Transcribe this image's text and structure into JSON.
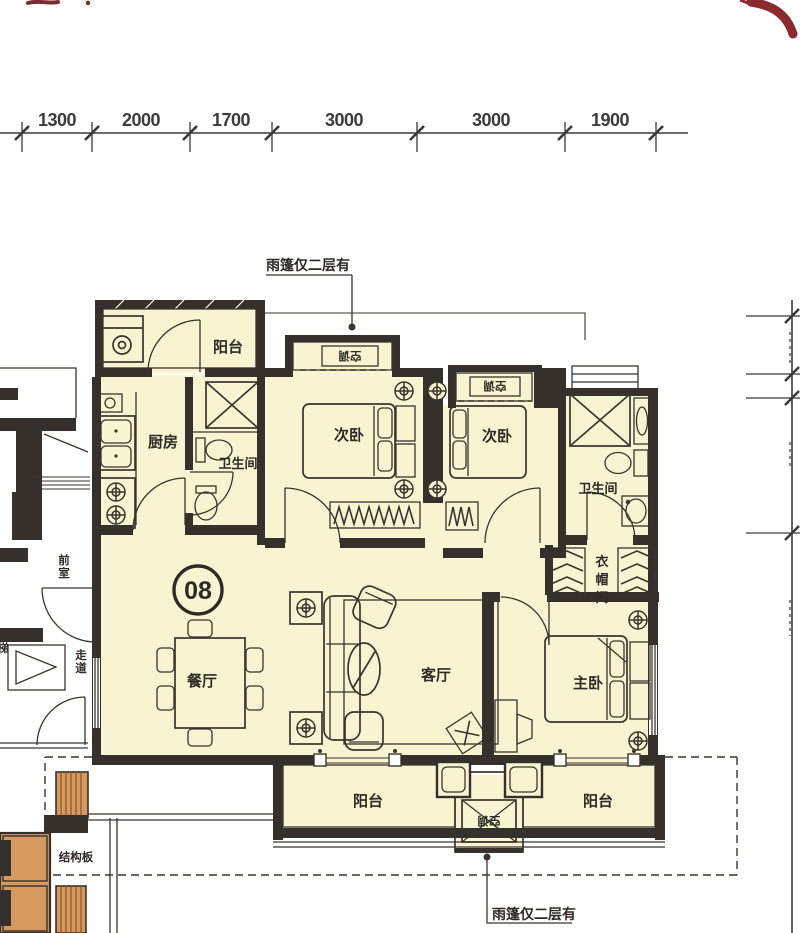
{
  "page": {
    "background": "#ffffff"
  },
  "colors": {
    "room_fill": "#f8f3d0",
    "wall": "#35302b",
    "line": "#3a342e",
    "accent_red": "#8b2b31",
    "stair_orange": "#d69a60",
    "stair_hatch": "#8a5526"
  },
  "dimensions": {
    "top": [
      "1300",
      "2000",
      "1700",
      "3000",
      "3000",
      "1900"
    ]
  },
  "unit": {
    "number": "08"
  },
  "rooms": {
    "balcony_top": "阳台",
    "kitchen": "厨房",
    "bath_top": "卫生间",
    "bedroom_left": "次卧",
    "bedroom_mid": "次卧",
    "bath_right": "卫生间",
    "cloakroom": "衣帽间",
    "dining": "餐厅",
    "living": "客厅",
    "master": "主卧",
    "balcony_bottom_left": "阳台",
    "balcony_bottom_right": "阳台"
  },
  "annotations": {
    "canopy_note_top": "雨篷仅二层有",
    "canopy_note_bottom": "雨篷仅二层有",
    "structural_slab": "结构板",
    "anteroom": "前室",
    "corridor": "走道",
    "stair_partial": "梯",
    "ac_unit": "空调"
  }
}
